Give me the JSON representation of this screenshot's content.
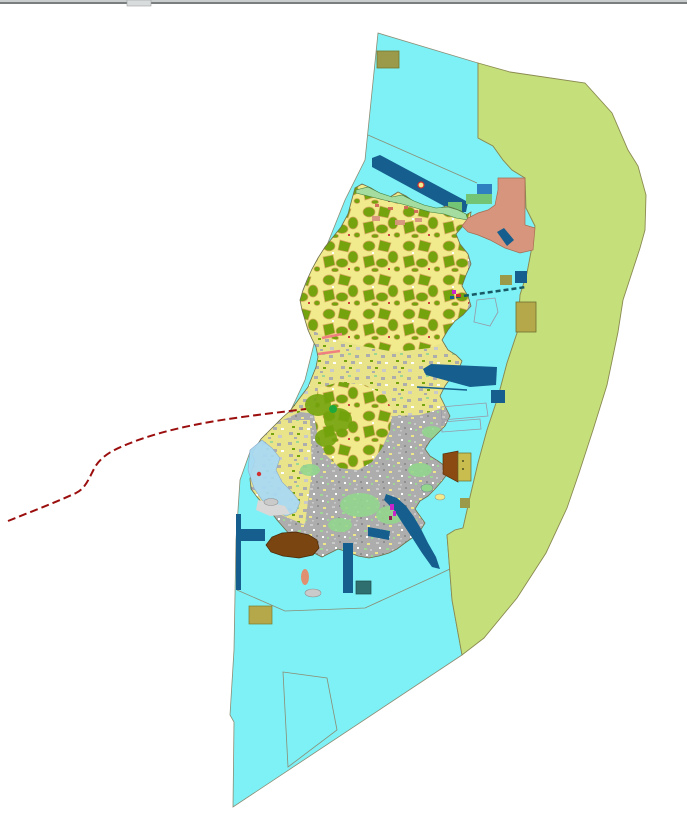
{
  "window": {
    "top_bar": {
      "bar_color": "#9EA2A2",
      "bar_highlight": "#C9CDCD",
      "bar_shadow": "#7A7E7E",
      "handle_color": "#D8DCDC"
    }
  },
  "palette": {
    "page_bg": "#FFFFFF",
    "water": "#7DF1F5",
    "water_border": "#8C8C74",
    "outer_zone": "#C5DF7B",
    "outer_border": "#8A8A50",
    "land_base": "#F1EB8D",
    "land_border": "#6F6F4A",
    "forest": "#74A30D",
    "forest_border": "#D7A65E",
    "coast_strip": "#A5DCA0",
    "urban": "#ADADAD",
    "mixed_bg": "#E9E38A",
    "salmon": "#D7957E",
    "deep_blue": "#155E8D",
    "medium_blue": "#2E7FC0",
    "bright_green": "#74C476",
    "pale_green": "#93D58D",
    "vivid_green": "#1FA83C",
    "khaki": "#9A9A4A",
    "tan_khaki": "#B4A84A",
    "house_khaki": "#C9BD50",
    "brown_dark": "#7A4510",
    "house_brown": "#8A4A12",
    "route_red": "#9B0E0E",
    "magenta": "#C826C8",
    "flats_blue": "#AADAF2",
    "light_gray": "#CACACA",
    "gray_patch": "#D8D8D8",
    "river_blue": "#2464C8",
    "dark_slate": "#2F6F6F",
    "causeway": "#175A66",
    "marker_red": "#D23030",
    "coast_speck": "#D06858",
    "parcel_line": "#9898A8",
    "pink_strip": "#F08080"
  },
  "map": {
    "kind": "land-use-gis-map",
    "features": [
      {
        "name": "coastal-water-zone",
        "color": "#7DF1F5"
      },
      {
        "name": "offshore-buffer-zone",
        "color": "#C5DF7B"
      },
      {
        "name": "island-land-base",
        "color": "#F1EB8D"
      },
      {
        "name": "forest-parcels",
        "color": "#74A30D"
      },
      {
        "name": "urban-fabric",
        "color": "#ADADAD"
      },
      {
        "name": "north-coast-greenbelt",
        "color": "#A5DCA0"
      },
      {
        "name": "northeast-development-area",
        "color": "#D7957E"
      },
      {
        "name": "harbor-and-channels",
        "color": "#155E8D"
      },
      {
        "name": "khaki-blocks",
        "color": "#9A9A4A"
      },
      {
        "name": "brown-sites",
        "color": "#7A4510"
      },
      {
        "name": "tidal-flats",
        "color": "#AADAF2"
      },
      {
        "name": "dashed-route-line",
        "color": "#9B0E0E"
      }
    ]
  }
}
